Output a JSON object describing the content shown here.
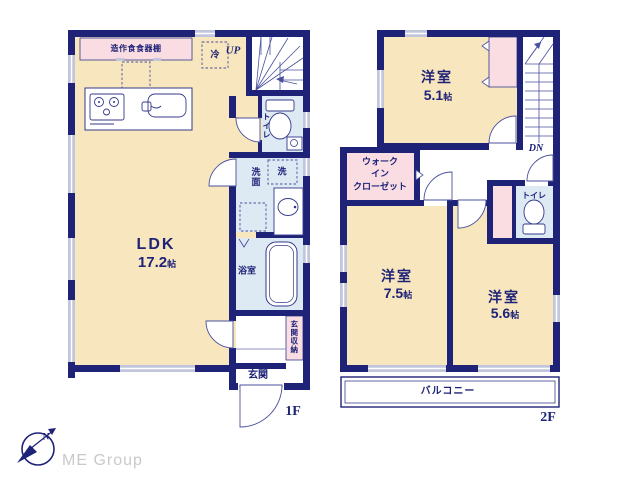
{
  "colors": {
    "wall_navy": "#1e2378",
    "room_cream": "#f7e6be",
    "closet_pink": "#fadde2",
    "wet_blue": "#dde9f3",
    "window_gray": "#c2c6dc",
    "text_navy": "#1e2378",
    "logo_gray": "#c9c9c9"
  },
  "floor1": {
    "floor_label": "1F",
    "cupboard_label": "造作食食器棚",
    "fridge_label": "冷",
    "stairs_label": "UP",
    "toilet_label": "トイレ",
    "laundry_label": "洗",
    "washroom_label": "洗面",
    "bath_label": "浴室",
    "genkan_label": "玄関",
    "genkan_storage_label": "玄関収納",
    "ldk": {
      "name": "LDK",
      "size_value": "17.2",
      "size_unit": "帖"
    }
  },
  "floor2": {
    "floor_label": "2F",
    "stairs_label": "DN",
    "toilet_label": "トイレ",
    "balcony_label": "バルコニー",
    "bedroom_small": {
      "name": "洋室",
      "size_value": "5.1",
      "size_unit": "帖"
    },
    "bedroom_large": {
      "name": "洋室",
      "size_value": "7.5",
      "size_unit": "帖"
    },
    "bedroom_mid": {
      "name": "洋室",
      "size_value": "5.6",
      "size_unit": "帖"
    },
    "wic_lines": {
      "line1": "ウォーク",
      "line2": "イン",
      "line3": "クローゼット"
    }
  },
  "logo": {
    "company": "ME Group",
    "compass_n": "N"
  }
}
